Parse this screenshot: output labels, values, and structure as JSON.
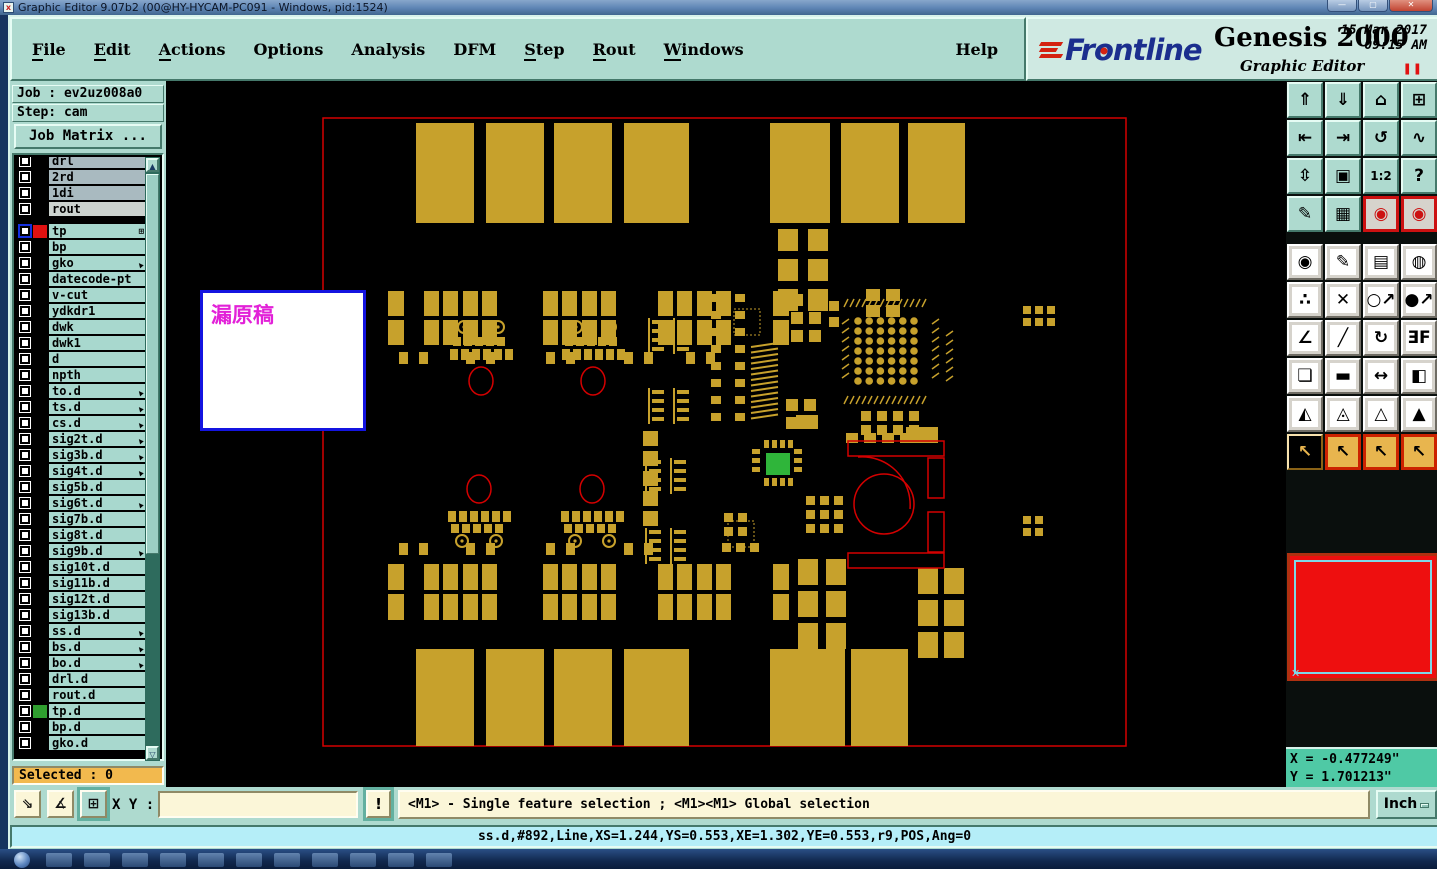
{
  "window": {
    "title": "Graphic Editor 9.07b2 (00@HY-HYCAM-PC091 - Windows, pid:1524)",
    "minimize": "—",
    "maximize": "▢",
    "close": "✕"
  },
  "menu": {
    "items": [
      {
        "label": "File",
        "underline": true
      },
      {
        "label": "Edit",
        "underline": true
      },
      {
        "label": "Actions",
        "underline": true
      },
      {
        "label": "Options",
        "underline": false
      },
      {
        "label": "Analysis",
        "underline": false
      },
      {
        "label": "DFM",
        "underline": false
      },
      {
        "label": "Step",
        "underline": true
      },
      {
        "label": "Rout",
        "underline": true
      },
      {
        "label": "Windows",
        "underline": true
      }
    ],
    "help_label": "Help"
  },
  "brand": {
    "name": "Frontline",
    "product": "Genesis 2000",
    "subtitle": "Graphic Editor",
    "date": "15 Mar 2017",
    "time": "09:15 AM",
    "pause_glyph": "❚❚"
  },
  "job_panel": {
    "job_label": "Job : ev2uz008a0",
    "step_label": "Step: cam",
    "matrix_button": "Job Matrix ...",
    "selected_label": "Selected : 0"
  },
  "layers": [
    {
      "label": "drl",
      "bg": "gray"
    },
    {
      "label": "2rd",
      "bg": "gray"
    },
    {
      "label": "1di",
      "bg": "gray"
    },
    {
      "label": "rout",
      "bg": "lite"
    },
    {
      "label": "tp",
      "gap_before": true,
      "swatch": "#e01111",
      "selected_box": true,
      "marker": "grid"
    },
    {
      "label": "bp"
    },
    {
      "label": "gko",
      "marker": "edit"
    },
    {
      "label": "datecode-pt"
    },
    {
      "label": "v-cut"
    },
    {
      "label": "ydkdr1"
    },
    {
      "label": "dwk"
    },
    {
      "label": "dwk1"
    },
    {
      "label": "d"
    },
    {
      "label": "npth"
    },
    {
      "label": "to.d",
      "marker": "edit"
    },
    {
      "label": "ts.d",
      "marker": "edit"
    },
    {
      "label": "cs.d",
      "marker": "edit"
    },
    {
      "label": "sig2t.d",
      "marker": "edit"
    },
    {
      "label": "sig3b.d",
      "marker": "edit"
    },
    {
      "label": "sig4t.d",
      "marker": "edit"
    },
    {
      "label": "sig5b.d"
    },
    {
      "label": "sig6t.d",
      "marker": "edit"
    },
    {
      "label": "sig7b.d"
    },
    {
      "label": "sig8t.d"
    },
    {
      "label": "sig9b.d",
      "marker": "edit"
    },
    {
      "label": "sig10t.d"
    },
    {
      "label": "sig11b.d"
    },
    {
      "label": "sig12t.d"
    },
    {
      "label": "sig13b.d"
    },
    {
      "label": "ss.d",
      "marker": "edit"
    },
    {
      "label": "bs.d",
      "marker": "edit"
    },
    {
      "label": "bo.d",
      "marker": "edit"
    },
    {
      "label": "drl.d"
    },
    {
      "label": "rout.d"
    },
    {
      "label": "tp.d",
      "swatch": "#2f9e2f"
    },
    {
      "label": "bp.d"
    },
    {
      "label": "gko.d"
    }
  ],
  "toolbar_right": {
    "rows": [
      {
        "cls": "t",
        "buttons": [
          {
            "n": "zoom-in",
            "g": "⇑"
          },
          {
            "n": "zoom-out",
            "g": "⇓"
          },
          {
            "n": "home-view",
            "g": "⌂"
          },
          {
            "n": "split-window-xy",
            "g": "⊞"
          }
        ]
      },
      {
        "cls": "t",
        "buttons": [
          {
            "n": "pan-left",
            "g": "⇤"
          },
          {
            "n": "pan-right",
            "g": "⇥"
          },
          {
            "n": "previous-view",
            "g": "↺"
          },
          {
            "n": "serpentine-redraw",
            "g": "∿"
          }
        ]
      },
      {
        "cls": "t",
        "buttons": [
          {
            "n": "zoom-fit",
            "g": "⇳"
          },
          {
            "n": "zoom-center",
            "g": "▣"
          },
          {
            "n": "scale-1-2",
            "g": "1:2"
          },
          {
            "n": "help-context",
            "g": "?"
          }
        ]
      },
      {
        "cls": "t",
        "buttons": [
          {
            "n": "setup-tools",
            "g": "✎"
          },
          {
            "n": "grid-toggle",
            "g": "▦"
          },
          {
            "n": "netlist-compare-a",
            "g": "◉",
            "cls": "rb"
          },
          {
            "n": "netlist-compare-b",
            "g": "◉",
            "cls": "rb"
          }
        ]
      },
      {
        "cls": "g",
        "buttons": [
          {
            "n": "move-feature",
            "g": "◉"
          },
          {
            "n": "reshape-feature",
            "g": "✎"
          },
          {
            "n": "measure-ruler",
            "g": "▤"
          },
          {
            "n": "select-dashed",
            "g": "◍"
          }
        ]
      },
      {
        "cls": "g",
        "buttons": [
          {
            "n": "net-endpoints",
            "g": "∴"
          },
          {
            "n": "delete-feature",
            "g": "✕"
          },
          {
            "n": "swap-small",
            "g": "○↗"
          },
          {
            "n": "swap-large",
            "g": "●↗"
          }
        ]
      },
      {
        "cls": "g",
        "buttons": [
          {
            "n": "angle-measure",
            "g": "∠"
          },
          {
            "n": "slope-line",
            "g": "╱"
          },
          {
            "n": "rotate-feature",
            "g": "↻"
          },
          {
            "n": "mirror-feature",
            "g": "ƎF"
          }
        ]
      },
      {
        "cls": "g",
        "buttons": [
          {
            "n": "copy-to-layer",
            "g": "❏"
          },
          {
            "n": "line-segment",
            "g": "▬"
          },
          {
            "n": "resize-horizontal",
            "g": "↔"
          },
          {
            "n": "shapes-boolean",
            "g": "◧"
          }
        ]
      },
      {
        "cls": "g",
        "buttons": [
          {
            "n": "arc-mode-1",
            "g": "◭"
          },
          {
            "n": "arc-mode-2",
            "g": "◬"
          },
          {
            "n": "arc-mode-3",
            "g": "△"
          },
          {
            "n": "arc-mode-4",
            "g": "▲"
          }
        ]
      },
      {
        "cls": "o",
        "buttons": [
          {
            "n": "select-single",
            "g": "↖",
            "cls": "k"
          },
          {
            "n": "select-frame",
            "g": "↖",
            "cls": "ob"
          },
          {
            "n": "select-polygon",
            "g": "↖",
            "cls": "ob"
          },
          {
            "n": "select-net",
            "g": "↖",
            "cls": "ob"
          }
        ]
      }
    ]
  },
  "canvas": {
    "overlay_text": "漏原稿"
  },
  "bottom_bar": {
    "buttons": [
      {
        "n": "resize-window-button",
        "g": "⇘"
      },
      {
        "n": "snap-angle-button",
        "g": "∡"
      },
      {
        "n": "grid-snap-button",
        "g": "⊞",
        "teal": true
      }
    ],
    "xy_label": "X Y :",
    "xy_value": "",
    "alert_button": "!",
    "message": "<M1> - Single feature selection ; <M1><M1> Global selection",
    "units_button": "Inch"
  },
  "status_bar": {
    "text": "ss.d,#892,Line,XS=1.244,YS=0.553,XE=1.302,YE=0.553,r9,POS,Ang=0"
  },
  "readout": {
    "x": "X = -0.477249\"",
    "y": "Y = 1.701213\""
  },
  "colors": {
    "ui_teal": "#aedacf",
    "copper": "#c7a12c",
    "outline_red": "#d40000",
    "pad_green": "#2fb53a",
    "selected_orange": "#f2b94e",
    "status_cyan": "#b5eef8",
    "readout_green": "#4fc9a5",
    "note_magenta": "#e221d8",
    "note_border": "#1414e0"
  }
}
